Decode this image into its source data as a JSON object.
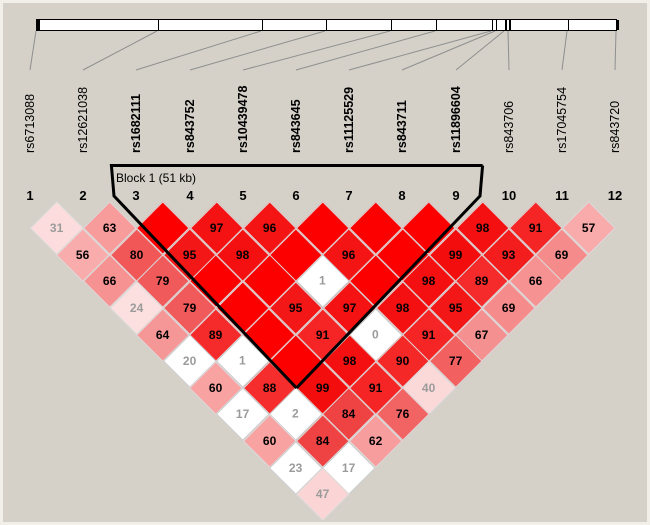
{
  "figure": {
    "kind": "haploview-ld-plot",
    "background": "#d5d1c9",
    "frame": "#f1efe8"
  },
  "theme": {
    "ld_full_red": "#fc0000",
    "white_cell": "#ffffff",
    "faint_text": "#9b9b9b",
    "text": "#000000",
    "connector_line": "#8f8f8f",
    "bar_fill": "#ffffff",
    "bar_border": "#000000",
    "block_outline": "#000000"
  },
  "block": {
    "label": "Block 1 (51 kb)",
    "from_snp": 3,
    "to_snp": 9,
    "span_kb": 51
  },
  "snps": [
    {
      "n": 1,
      "id": "rs6713088",
      "bold": false,
      "tick": 36
    },
    {
      "n": 2,
      "id": "rs12621038",
      "bold": false,
      "tick": 157
    },
    {
      "n": 3,
      "id": "rs1682111",
      "bold": true,
      "tick": 261
    },
    {
      "n": 4,
      "id": "rs843752",
      "bold": true,
      "tick": 325
    },
    {
      "n": 5,
      "id": "rs10439478",
      "bold": true,
      "tick": 390
    },
    {
      "n": 6,
      "id": "rs843645",
      "bold": true,
      "tick": 435
    },
    {
      "n": 7,
      "id": "rs11125529",
      "bold": true,
      "tick": 491
    },
    {
      "n": 8,
      "id": "rs843711",
      "bold": true,
      "tick": 495
    },
    {
      "n": 9,
      "id": "rs11896604",
      "bold": true,
      "tick": 504
    },
    {
      "n": 10,
      "id": "rs843706",
      "bold": false,
      "tick": 508
    },
    {
      "n": 11,
      "id": "rs17045754",
      "bold": false,
      "tick": 567
    },
    {
      "n": 12,
      "id": "rs843720",
      "bold": false,
      "tick": 616
    }
  ],
  "cells_by_distance": [
    {
      "d": 1,
      "cells": [
        {
          "v": 31,
          "c": "#fcdcdc"
        },
        {
          "v": 63,
          "c": "#f79b9b"
        },
        {
          "v": null,
          "c": "#fc0000"
        },
        {
          "v": 97,
          "c": "#f41212"
        },
        {
          "v": 96,
          "c": "#f41414"
        },
        {
          "v": null,
          "c": "#fc0000"
        },
        {
          "v": null,
          "c": "#fc0000"
        },
        {
          "v": null,
          "c": "#fc0000"
        },
        {
          "v": 98,
          "c": "#f41010"
        },
        {
          "v": 91,
          "c": "#f52525"
        },
        {
          "v": 57,
          "c": "#f9aaaa"
        }
      ]
    },
    {
      "d": 2,
      "cells": [
        {
          "v": 56,
          "c": "#f9acac"
        },
        {
          "v": 80,
          "c": "#f15757"
        },
        {
          "v": 95,
          "c": "#f41717"
        },
        {
          "v": 98,
          "c": "#f41010"
        },
        {
          "v": null,
          "c": "#fc0000"
        },
        {
          "v": 96,
          "c": "#f41414"
        },
        {
          "v": null,
          "c": "#fc0000"
        },
        {
          "v": 99,
          "c": "#f40d0d"
        },
        {
          "v": 93,
          "c": "#f41d1d"
        },
        {
          "v": 69,
          "c": "#f58b8b"
        }
      ]
    },
    {
      "d": 3,
      "cells": [
        {
          "v": 66,
          "c": "#f69292"
        },
        {
          "v": 79,
          "c": "#f15a5a"
        },
        {
          "v": null,
          "c": "#fc0000"
        },
        {
          "v": null,
          "c": "#fc0000"
        },
        {
          "v": 1,
          "c": "#ffffff"
        },
        {
          "v": null,
          "c": "#fc0000"
        },
        {
          "v": 98,
          "c": "#f41010"
        },
        {
          "v": 89,
          "c": "#f52a2a"
        },
        {
          "v": 66,
          "c": "#f69292"
        }
      ]
    },
    {
      "d": 4,
      "cells": [
        {
          "v": 24,
          "c": "#fcdfdf"
        },
        {
          "v": 79,
          "c": "#f15a5a"
        },
        {
          "v": null,
          "c": "#fc0000"
        },
        {
          "v": 95,
          "c": "#f41717"
        },
        {
          "v": 97,
          "c": "#f41212"
        },
        {
          "v": 98,
          "c": "#f41010"
        },
        {
          "v": 95,
          "c": "#f41717"
        },
        {
          "v": 69,
          "c": "#f58b8b"
        }
      ]
    },
    {
      "d": 5,
      "cells": [
        {
          "v": 64,
          "c": "#f69797"
        },
        {
          "v": 89,
          "c": "#f52a2a"
        },
        {
          "v": null,
          "c": "#fc0000"
        },
        {
          "v": 91,
          "c": "#f52525"
        },
        {
          "v": 0,
          "c": "#ffffff"
        },
        {
          "v": 91,
          "c": "#f52525"
        },
        {
          "v": 67,
          "c": "#f59090"
        }
      ]
    },
    {
      "d": 6,
      "cells": [
        {
          "v": 20,
          "c": "#ffffff"
        },
        {
          "v": 1,
          "c": "#ffffff"
        },
        {
          "v": null,
          "c": "#fc0000"
        },
        {
          "v": 98,
          "c": "#f41010"
        },
        {
          "v": 90,
          "c": "#f52828"
        },
        {
          "v": 77,
          "c": "#f26060"
        }
      ]
    },
    {
      "d": 7,
      "cells": [
        {
          "v": 60,
          "c": "#f8a2a2"
        },
        {
          "v": 88,
          "c": "#f52d2d"
        },
        {
          "v": 99,
          "c": "#f40d0d"
        },
        {
          "v": 91,
          "c": "#f52525"
        },
        {
          "v": 40,
          "c": "#fcd9d9"
        }
      ]
    },
    {
      "d": 8,
      "cells": [
        {
          "v": 17,
          "c": "#ffffff"
        },
        {
          "v": 2,
          "c": "#ffffff"
        },
        {
          "v": 84,
          "c": "#ef4343"
        },
        {
          "v": 76,
          "c": "#f26363"
        }
      ]
    },
    {
      "d": 9,
      "cells": [
        {
          "v": 60,
          "c": "#f8a2a2"
        },
        {
          "v": 84,
          "c": "#ef4343"
        },
        {
          "v": 62,
          "c": "#f79d9d"
        }
      ]
    },
    {
      "d": 10,
      "cells": [
        {
          "v": 23,
          "c": "#ffffff"
        },
        {
          "v": 17,
          "c": "#ffffff"
        }
      ]
    },
    {
      "d": 11,
      "cells": [
        {
          "v": 47,
          "c": "#fbd5d5"
        }
      ]
    }
  ],
  "chart_data": {
    "type": "heatmap",
    "subtype": "pairwise-linkage-disequilibrium-triangle",
    "value_meaning": "D' x 100 between SNP pairs; unlabeled bright red diamonds = 100 (D'=1.0); white diamonds = low-confidence LD",
    "snps": [
      "rs6713088",
      "rs12621038",
      "rs1682111",
      "rs843752",
      "rs10439478",
      "rs843645",
      "rs11125529",
      "rs843711",
      "rs11896604",
      "rs843706",
      "rs17045754",
      "rs843720"
    ],
    "blocks": [
      {
        "label": "Block 1 (51 kb)",
        "snp_indices": [
          3,
          4,
          5,
          6,
          7,
          8,
          9
        ],
        "span_kb": 51
      }
    ],
    "upper_triangle": [
      [
        31,
        56,
        66,
        24,
        64,
        20,
        60,
        17,
        60,
        23,
        47
      ],
      [
        63,
        80,
        79,
        79,
        89,
        1,
        88,
        2,
        84,
        17
      ],
      [
        100,
        95,
        100,
        100,
        100,
        100,
        99,
        84,
        62
      ],
      [
        97,
        98,
        100,
        95,
        91,
        98,
        91,
        76
      ],
      [
        96,
        100,
        1,
        97,
        0,
        90,
        40
      ],
      [
        100,
        96,
        100,
        98,
        91,
        77
      ],
      [
        100,
        100,
        98,
        95,
        67
      ],
      [
        100,
        99,
        89,
        69
      ],
      [
        98,
        93,
        66
      ],
      [
        91,
        69
      ],
      [
        57
      ]
    ],
    "white_cells": [
      [
        1,
        7
      ],
      [
        1,
        9
      ],
      [
        1,
        11
      ],
      [
        2,
        8
      ],
      [
        2,
        10
      ],
      [
        2,
        12
      ],
      [
        5,
        8
      ],
      [
        5,
        10
      ]
    ],
    "legend_position": "none",
    "grid": false
  }
}
